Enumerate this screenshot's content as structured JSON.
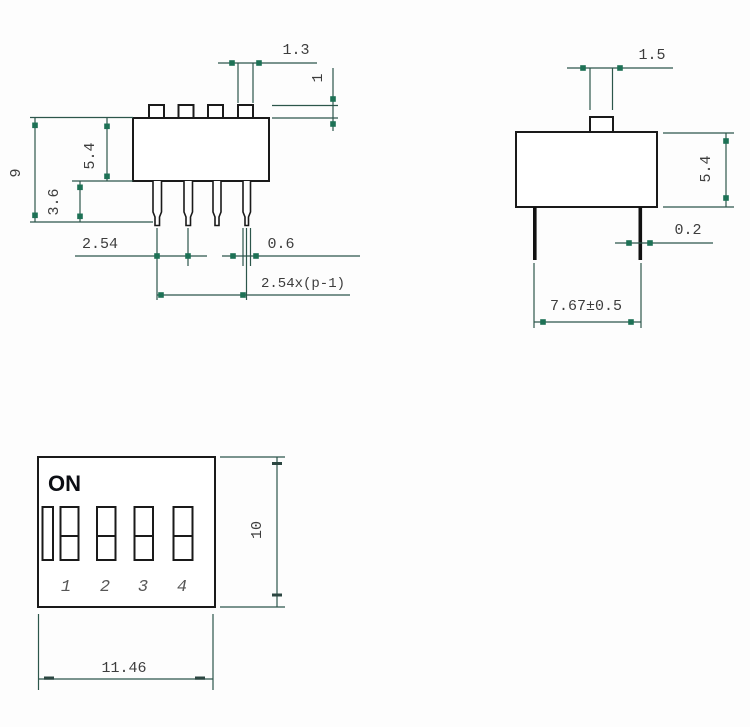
{
  "drawing_title": "DIP switch dimensional drawing",
  "colors": {
    "background": "#fdfdfd",
    "part_outline": "#1a1a1a",
    "dimension_line": "#2c564b",
    "dimension_arrow": "#1d7155",
    "dimension_text": "#3d3d3d",
    "on_label_text": "#0c0e14",
    "position_number_text": "#575757"
  },
  "front_view": {
    "dim_actuator_width": "1.3",
    "dim_actuator_height": "1",
    "dim_body_height": "5.4",
    "dim_overall_height": "9",
    "dim_pin_length": "3.6",
    "dim_pin_pitch": "2.54",
    "dim_pin_width": "0.6",
    "dim_pin_span": "2.54x(p-1)"
  },
  "side_view": {
    "dim_actuator_width": "1.5",
    "dim_body_height": "5.4",
    "dim_pin_thickness": "0.2",
    "dim_pin_row_spacing": "7.67±0.5"
  },
  "top_view": {
    "on_label": "ON",
    "switch_numbers": [
      "1",
      "2",
      "3",
      "4"
    ],
    "dim_body_depth": "10",
    "dim_body_width": "11.46"
  }
}
